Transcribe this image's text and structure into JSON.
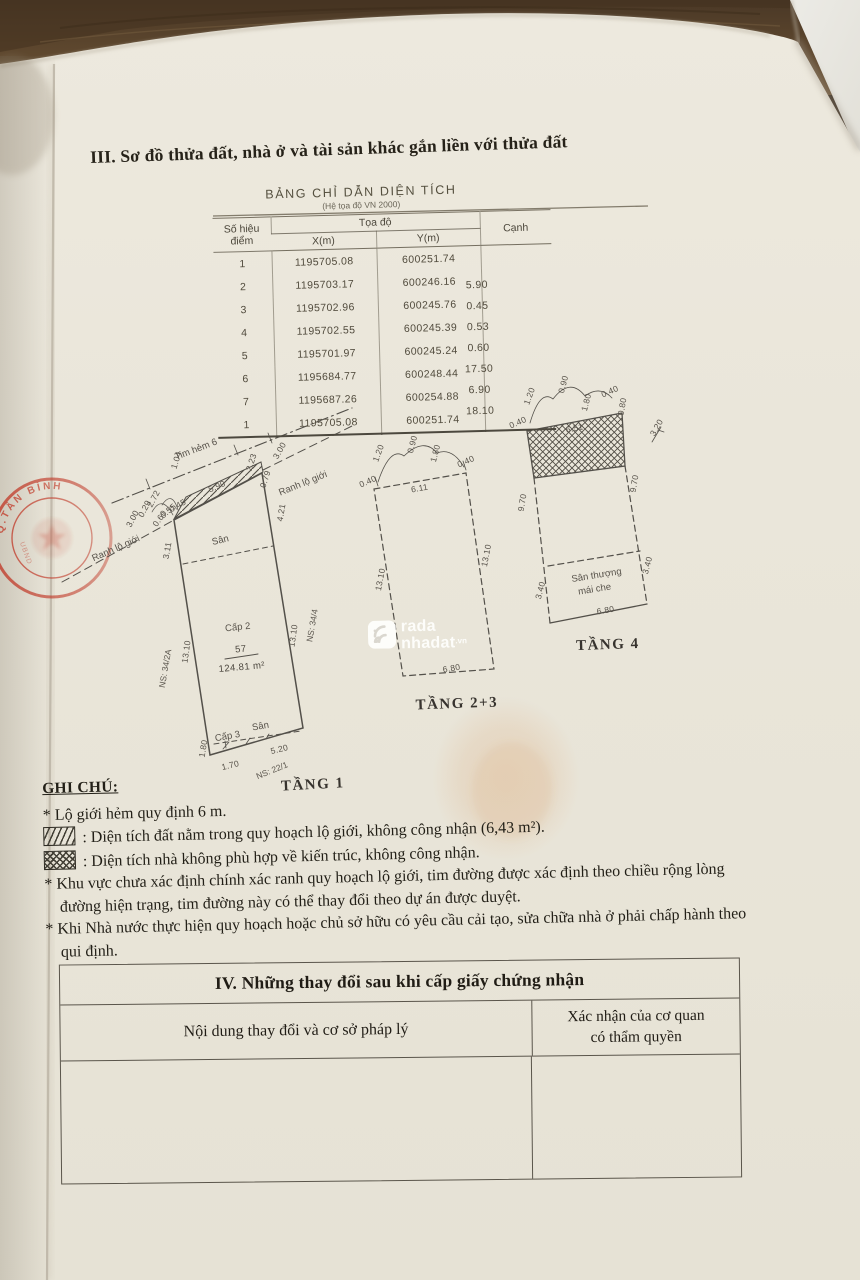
{
  "section_title": "III. Sơ đồ thửa đất, nhà ở và tài sản khác gắn liền với thửa đất",
  "area_table": {
    "title": "BẢNG CHỈ DẪN DIỆN TÍCH",
    "subtitle": "(Hệ tọa độ VN 2000)",
    "col_point": "Số hiệu điểm",
    "col_coords": "Tọa độ",
    "col_x": "X(m)",
    "col_y": "Y(m)",
    "col_edge": "Cạnh",
    "rows": [
      {
        "p": "1",
        "x": "1195705.08",
        "y": "600251.74"
      },
      {
        "p": "2",
        "x": "1195703.17",
        "y": "600246.16"
      },
      {
        "p": "3",
        "x": "1195702.96",
        "y": "600245.76"
      },
      {
        "p": "4",
        "x": "1195702.55",
        "y": "600245.39"
      },
      {
        "p": "5",
        "x": "1195701.97",
        "y": "600245.24"
      },
      {
        "p": "6",
        "x": "1195684.77",
        "y": "600248.44"
      },
      {
        "p": "7",
        "x": "1195687.26",
        "y": "600254.88"
      },
      {
        "p": "1",
        "x": "1195705.08",
        "y": "600251.74"
      }
    ],
    "edges": [
      "5.90",
      "0.45",
      "0.53",
      "0.60",
      "17.50",
      "6.90",
      "18.10"
    ]
  },
  "plans": {
    "tang1": {
      "texts": [
        {
          "t": "Tim hẻm 6",
          "x": 197,
          "y": 452,
          "r": -21,
          "c": "z"
        },
        {
          "t": "1.04",
          "x": 179,
          "y": 461,
          "r": -72,
          "c": "d"
        },
        {
          "t": "2.23",
          "x": 254,
          "y": 463,
          "r": -72,
          "c": "d"
        },
        {
          "t": "3.00",
          "x": 282,
          "y": 452,
          "r": -60,
          "c": "d"
        },
        {
          "t": "0.79",
          "x": 268,
          "y": 480,
          "r": -72,
          "c": "d"
        },
        {
          "t": "Ranh lộ giới",
          "x": 304,
          "y": 486,
          "r": -22,
          "c": "z"
        },
        {
          "t": "Ranh lộ giới",
          "x": 117,
          "y": 551,
          "r": -24,
          "c": "z"
        },
        {
          "t": "3.00",
          "x": 135,
          "y": 520,
          "r": -62,
          "c": "d"
        },
        {
          "t": "0.29",
          "x": 147,
          "y": 510,
          "r": -62,
          "c": "d"
        },
        {
          "t": "2.72",
          "x": 156,
          "y": 500,
          "r": -62,
          "c": "d"
        },
        {
          "t": "0.60",
          "x": 162,
          "y": 520,
          "r": -55,
          "c": "d"
        },
        {
          "t": "0.55",
          "x": 170,
          "y": 513,
          "r": -40,
          "c": "d"
        },
        {
          "t": "0.45",
          "x": 179,
          "y": 508,
          "r": -30,
          "c": "d"
        },
        {
          "t": "5.90",
          "x": 218,
          "y": 489,
          "r": -23,
          "c": "d"
        },
        {
          "t": "Sân",
          "x": 221,
          "y": 543,
          "r": -14,
          "c": "z"
        },
        {
          "t": "3.11",
          "x": 170,
          "y": 551,
          "r": -80,
          "c": "d"
        },
        {
          "t": "4.21",
          "x": 284,
          "y": 513,
          "r": -80,
          "c": "d"
        },
        {
          "t": "13.10",
          "x": 189,
          "y": 652,
          "r": -82,
          "c": "d"
        },
        {
          "t": "NS: 34/2A",
          "x": 168,
          "y": 669,
          "r": -80,
          "c": "n"
        },
        {
          "t": "13.10",
          "x": 296,
          "y": 636,
          "r": -82,
          "c": "d"
        },
        {
          "t": "NS: 34/4",
          "x": 315,
          "y": 626,
          "r": -80,
          "c": "n"
        },
        {
          "t": "Cấp 2",
          "x": 238,
          "y": 630,
          "r": -6,
          "c": "z"
        },
        {
          "t": "57",
          "x": 241,
          "y": 652,
          "r": -5,
          "c": "d2"
        },
        {
          "t": "124.81 m²",
          "x": 242,
          "y": 670,
          "r": -5,
          "c": "d2"
        },
        {
          "t": "Cấp 3",
          "x": 228,
          "y": 739,
          "r": -10,
          "c": "z"
        },
        {
          "t": "Sân",
          "x": 261,
          "y": 729,
          "r": -10,
          "c": "z"
        },
        {
          "t": "1.80",
          "x": 206,
          "y": 749,
          "r": -80,
          "c": "d"
        },
        {
          "t": "1.70",
          "x": 231,
          "y": 768,
          "r": -14,
          "c": "d"
        },
        {
          "t": "5.20",
          "x": 280,
          "y": 752,
          "r": -14,
          "c": "d"
        },
        {
          "t": "NS: 22/1",
          "x": 273,
          "y": 773,
          "r": -22,
          "c": "n"
        },
        {
          "t": "TẦNG 1",
          "x": 313,
          "y": 789,
          "r": -3,
          "c": "L"
        }
      ]
    },
    "tang23": {
      "texts": [
        {
          "t": "0.40",
          "x": 369,
          "y": 484,
          "r": -24,
          "c": "d"
        },
        {
          "t": "1.20",
          "x": 381,
          "y": 454,
          "r": -70,
          "c": "d"
        },
        {
          "t": "0.90",
          "x": 415,
          "y": 445,
          "r": -75,
          "c": "d"
        },
        {
          "t": "1.80",
          "x": 438,
          "y": 454,
          "r": -75,
          "c": "d"
        },
        {
          "t": "0.40",
          "x": 467,
          "y": 464,
          "r": -24,
          "c": "d"
        },
        {
          "t": "6.11",
          "x": 420,
          "y": 491,
          "r": -10,
          "c": "d"
        },
        {
          "t": "13.10",
          "x": 383,
          "y": 580,
          "r": -79,
          "c": "d"
        },
        {
          "t": "13.10",
          "x": 489,
          "y": 556,
          "r": -79,
          "c": "d"
        },
        {
          "t": "6.80",
          "x": 452,
          "y": 671,
          "r": -10,
          "c": "d"
        },
        {
          "t": "TẦNG 2+3",
          "x": 457,
          "y": 708,
          "r": -2,
          "c": "L"
        }
      ]
    },
    "tang4": {
      "texts": [
        {
          "t": "0.40",
          "x": 519,
          "y": 425,
          "r": -24,
          "c": "d"
        },
        {
          "t": "1.20",
          "x": 532,
          "y": 397,
          "r": -70,
          "c": "d"
        },
        {
          "t": "0.90",
          "x": 566,
          "y": 385,
          "r": -75,
          "c": "d"
        },
        {
          "t": "1.80",
          "x": 589,
          "y": 403,
          "r": -75,
          "c": "d"
        },
        {
          "t": "0.40",
          "x": 611,
          "y": 394,
          "r": -24,
          "c": "d"
        },
        {
          "t": "0.80",
          "x": 625,
          "y": 407,
          "r": -80,
          "c": "d"
        },
        {
          "t": "3.20",
          "x": 659,
          "y": 429,
          "r": -60,
          "c": "d"
        },
        {
          "t": "6.51",
          "x": 575,
          "y": 431,
          "r": -11,
          "c": "d"
        },
        {
          "t": "9.70",
          "x": 525,
          "y": 503,
          "r": -80,
          "c": "d"
        },
        {
          "t": "9.70",
          "x": 637,
          "y": 484,
          "r": -80,
          "c": "d"
        },
        {
          "t": "3.40",
          "x": 543,
          "y": 591,
          "r": -75,
          "c": "d"
        },
        {
          "t": "3.40",
          "x": 650,
          "y": 566,
          "r": -75,
          "c": "d"
        },
        {
          "t": "Sân thượng",
          "x": 597,
          "y": 578,
          "r": -9,
          "c": "z"
        },
        {
          "t": "mái che",
          "x": 595,
          "y": 592,
          "r": -9,
          "c": "z"
        },
        {
          "t": "6.80",
          "x": 606,
          "y": 613,
          "r": -10,
          "c": "d"
        },
        {
          "t": "TẦNG 4",
          "x": 608,
          "y": 649,
          "r": -2,
          "c": "L"
        }
      ]
    }
  },
  "watermark": {
    "line1": "rada",
    "line2": "nhadat",
    "suffix": ".vn"
  },
  "stamp": {
    "arc_text": "PHƯỜNG 2 Q.TÂN BÌNH",
    "inner_text": "UBND"
  },
  "notes": {
    "heading": "GHI CHÚ:",
    "items": [
      {
        "type": "text",
        "text": "* Lộ giới hẻm quy định 6 m."
      },
      {
        "type": "diag",
        "text": ": Diện tích đất nằm trong quy hoạch lộ giới, không công nhận (6,43 m²)."
      },
      {
        "type": "cross",
        "text": ": Diện tích nhà không phù hợp về kiến trúc, không công nhận."
      },
      {
        "type": "text",
        "text": "* Khu vực chưa xác định chính xác ranh quy hoạch lộ giới, tim đường được xác định theo chiều rộng lòng đường hiện trạng, tim đường này có thể thay đổi theo dự án được duyệt."
      },
      {
        "type": "text",
        "text": "* Khi Nhà nước thực hiện quy hoạch hoặc chủ sở hữu có yêu cầu cải tạo, sửa chữa nhà ở phải chấp hành theo qui định."
      }
    ]
  },
  "changes_table": {
    "title": "IV. Những thay đổi sau khi cấp giấy chứng nhận",
    "col_content": "Nội dung thay đổi và cơ sở pháp lý",
    "col_confirm_line1": "Xác nhận của cơ quan",
    "col_confirm_line2": "có thẩm quyền"
  }
}
